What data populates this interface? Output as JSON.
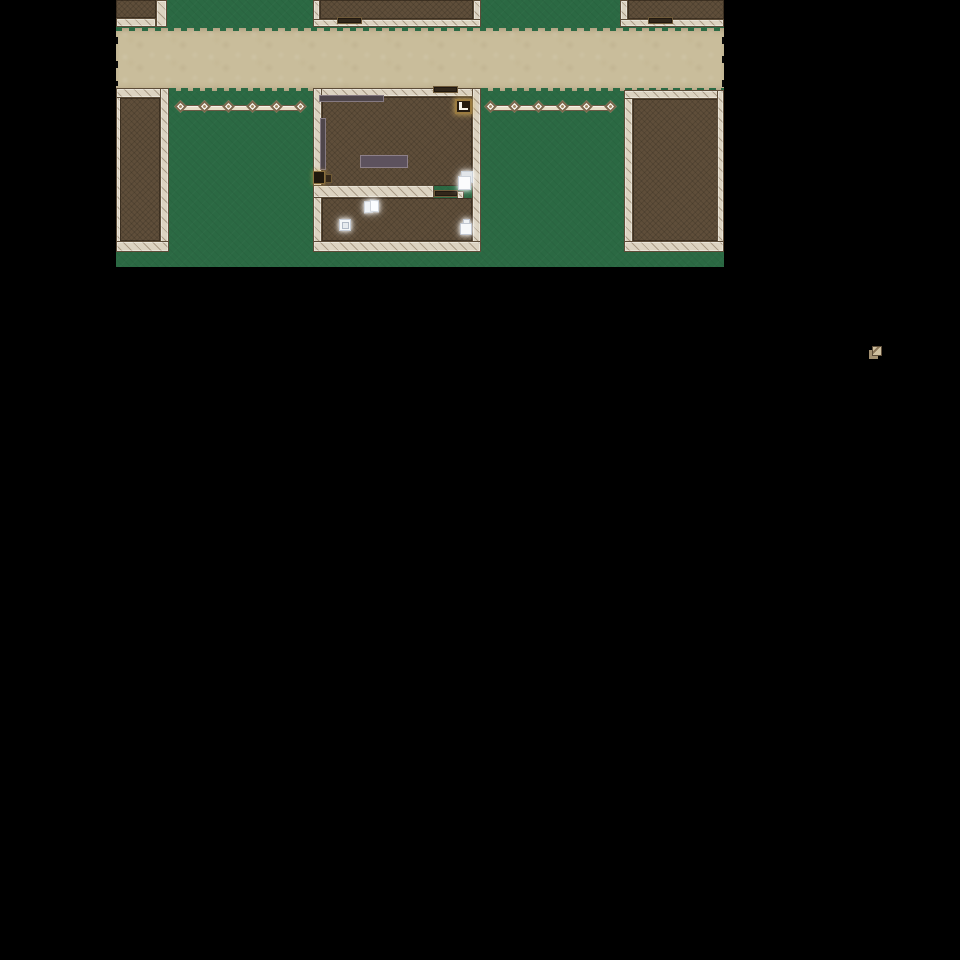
{
  "meta": {
    "app": "rpg-village-map",
    "description": "Top-down 2D RPG village scene: dirt road between buildings, fenced yards, shop interior with glowing pickup items; rest of screen is black.",
    "background": "#000000"
  },
  "palette": {
    "grass": "#2b6943",
    "path": "#c9bd9b",
    "wall_fill": "#dcd3c1",
    "wall_hatch": "#7a6650",
    "wall_edge": "#5c4c38",
    "floor": "#5f4e3a",
    "door": "#32271a",
    "fence_light": "#f2ebdb",
    "fence_dark": "#6b5944",
    "furniture_mauve": "#4f464b",
    "furniture_mauve_light": "#8d8089",
    "item_white": "#f6f8fa",
    "ledger_gold": "#9a7b40",
    "glow_warm": "#e0ba62",
    "sprite_tan": "#cfc0a0"
  },
  "map": {
    "x": 116,
    "y": 0,
    "width": 608,
    "height": 267,
    "elements": [
      {
        "name": "dirt-road",
        "type": "path",
        "x": 0,
        "y": 28,
        "w": 608,
        "h": 63,
        "interactable": false
      },
      {
        "name": "dirt-road-edge-top",
        "type": "path-edge-top",
        "x": 0,
        "y": 28,
        "w": 608,
        "h": 3,
        "interactable": false
      },
      {
        "name": "dirt-road-edge-bottom",
        "type": "path-edge-bottom",
        "x": 0,
        "y": 88,
        "w": 608,
        "h": 3,
        "interactable": false
      },
      {
        "name": "map-edge-tick-w1",
        "type": "edge-tick",
        "x": 0,
        "y": 37,
        "w": 2,
        "h": 7,
        "interactable": false
      },
      {
        "name": "map-edge-tick-w2",
        "type": "edge-tick",
        "x": 0,
        "y": 61,
        "w": 2,
        "h": 7,
        "interactable": false
      },
      {
        "name": "map-edge-tick-w3",
        "type": "edge-tick",
        "x": 0,
        "y": 81,
        "w": 2,
        "h": 5,
        "interactable": false
      },
      {
        "name": "map-edge-tick-e1",
        "type": "edge-tick",
        "x": 606,
        "y": 37,
        "w": 2,
        "h": 7,
        "interactable": false
      },
      {
        "name": "map-edge-tick-e2",
        "type": "edge-tick",
        "x": 606,
        "y": 56,
        "w": 2,
        "h": 7,
        "interactable": false
      },
      {
        "name": "map-edge-tick-e3",
        "type": "edge-tick",
        "x": 606,
        "y": 80,
        "w": 2,
        "h": 7,
        "interactable": false
      },
      {
        "name": "map-edge-tick-e4",
        "type": "edge-tick",
        "x": 606,
        "y": 97,
        "w": 2,
        "h": 6,
        "interactable": false
      },
      {
        "name": "building-nw-floor",
        "type": "floor",
        "x": 0,
        "y": 0,
        "w": 40,
        "h": 18,
        "interactable": false
      },
      {
        "name": "building-nw-wall-right",
        "type": "wall-v",
        "x": 40,
        "y": 0,
        "w": 11,
        "h": 27,
        "interactable": false
      },
      {
        "name": "building-nw-wall-bottom",
        "type": "wall-h",
        "x": 0,
        "y": 18,
        "w": 40,
        "h": 9,
        "interactable": false
      },
      {
        "name": "building-n-wall-left",
        "type": "wall-v",
        "x": 197,
        "y": 0,
        "w": 7,
        "h": 27,
        "interactable": false
      },
      {
        "name": "building-n-floor",
        "type": "floor",
        "x": 204,
        "y": 0,
        "w": 153,
        "h": 19,
        "interactable": false
      },
      {
        "name": "building-n-wall-right",
        "type": "wall-v",
        "x": 357,
        "y": 0,
        "w": 8,
        "h": 27,
        "interactable": false
      },
      {
        "name": "building-n-wall-bottom",
        "type": "wall-h",
        "x": 197,
        "y": 19,
        "w": 168,
        "h": 8,
        "interactable": false
      },
      {
        "name": "building-n-door",
        "type": "door-lintel",
        "x": 221,
        "y": 17,
        "w": 25,
        "h": 7,
        "interactable": true
      },
      {
        "name": "building-ne-wall-left",
        "type": "wall-v",
        "x": 504,
        "y": 0,
        "w": 8,
        "h": 27,
        "interactable": false
      },
      {
        "name": "building-ne-floor",
        "type": "floor",
        "x": 512,
        "y": 0,
        "w": 96,
        "h": 19,
        "interactable": false
      },
      {
        "name": "building-ne-wall-bottom",
        "type": "wall-h",
        "x": 504,
        "y": 19,
        "w": 104,
        "h": 8,
        "interactable": false
      },
      {
        "name": "building-ne-door",
        "type": "door-lintel",
        "x": 532,
        "y": 17,
        "w": 25,
        "h": 7,
        "interactable": true
      },
      {
        "name": "fence-west-rail",
        "type": "fence-rail",
        "x": 64,
        "y": 105,
        "w": 122,
        "h": 6,
        "interactable": false
      },
      {
        "name": "fence-west-post-1",
        "type": "fence-post",
        "x": 60,
        "y": 102,
        "w": 9,
        "h": 9,
        "interactable": false
      },
      {
        "name": "fence-west-post-2",
        "type": "fence-post",
        "x": 84,
        "y": 102,
        "w": 9,
        "h": 9,
        "interactable": false
      },
      {
        "name": "fence-west-post-3",
        "type": "fence-post",
        "x": 108,
        "y": 102,
        "w": 9,
        "h": 9,
        "interactable": false
      },
      {
        "name": "fence-west-post-4",
        "type": "fence-post",
        "x": 132,
        "y": 102,
        "w": 9,
        "h": 9,
        "interactable": false
      },
      {
        "name": "fence-west-post-5",
        "type": "fence-post",
        "x": 156,
        "y": 102,
        "w": 9,
        "h": 9,
        "interactable": false
      },
      {
        "name": "fence-west-post-6",
        "type": "fence-post",
        "x": 180,
        "y": 102,
        "w": 9,
        "h": 9,
        "interactable": false
      },
      {
        "name": "fence-east-rail",
        "type": "fence-rail",
        "x": 375,
        "y": 105,
        "w": 122,
        "h": 6,
        "interactable": false
      },
      {
        "name": "fence-east-post-1",
        "type": "fence-post",
        "x": 370,
        "y": 102,
        "w": 9,
        "h": 9,
        "interactable": false
      },
      {
        "name": "fence-east-post-2",
        "type": "fence-post",
        "x": 394,
        "y": 102,
        "w": 9,
        "h": 9,
        "interactable": false
      },
      {
        "name": "fence-east-post-3",
        "type": "fence-post",
        "x": 418,
        "y": 102,
        "w": 9,
        "h": 9,
        "interactable": false
      },
      {
        "name": "fence-east-post-4",
        "type": "fence-post",
        "x": 442,
        "y": 102,
        "w": 9,
        "h": 9,
        "interactable": false
      },
      {
        "name": "fence-east-post-5",
        "type": "fence-post",
        "x": 466,
        "y": 102,
        "w": 9,
        "h": 9,
        "interactable": false
      },
      {
        "name": "fence-east-post-6",
        "type": "fence-post",
        "x": 490,
        "y": 102,
        "w": 9,
        "h": 9,
        "interactable": false
      },
      {
        "name": "building-sw-wall-left",
        "type": "wall-v",
        "x": 0,
        "y": 88,
        "w": 5,
        "h": 164,
        "interactable": false
      },
      {
        "name": "building-sw-wall-top",
        "type": "wall-h",
        "x": 0,
        "y": 88,
        "w": 53,
        "h": 10,
        "interactable": false
      },
      {
        "name": "building-sw-floor",
        "type": "floor",
        "x": 4,
        "y": 98,
        "w": 40,
        "h": 143,
        "interactable": false
      },
      {
        "name": "building-sw-wall-right",
        "type": "wall-v",
        "x": 44,
        "y": 88,
        "w": 9,
        "h": 164,
        "interactable": false
      },
      {
        "name": "building-sw-wall-bottom",
        "type": "wall-h",
        "x": 0,
        "y": 241,
        "w": 53,
        "h": 11,
        "interactable": false
      },
      {
        "name": "building-se-wall-left",
        "type": "wall-v",
        "x": 508,
        "y": 90,
        "w": 9,
        "h": 162,
        "interactable": false
      },
      {
        "name": "building-se-wall-top",
        "type": "wall-h",
        "x": 508,
        "y": 90,
        "w": 100,
        "h": 9,
        "interactable": false
      },
      {
        "name": "building-se-floor",
        "type": "floor",
        "x": 517,
        "y": 99,
        "w": 85,
        "h": 142,
        "interactable": false
      },
      {
        "name": "building-se-wall-right",
        "type": "wall-v",
        "x": 601,
        "y": 90,
        "w": 7,
        "h": 162,
        "interactable": false
      },
      {
        "name": "building-se-wall-bottom",
        "type": "wall-h",
        "x": 508,
        "y": 241,
        "w": 100,
        "h": 11,
        "interactable": false
      },
      {
        "name": "shop-wall-top",
        "type": "wall-h",
        "x": 197,
        "y": 88,
        "w": 168,
        "h": 9,
        "interactable": false
      },
      {
        "name": "shop-wall-left",
        "type": "wall-v",
        "x": 197,
        "y": 88,
        "w": 9,
        "h": 164,
        "interactable": false
      },
      {
        "name": "shop-wall-right",
        "type": "wall-v",
        "x": 356,
        "y": 88,
        "w": 9,
        "h": 164,
        "interactable": false
      },
      {
        "name": "shop-floor-main",
        "type": "floor",
        "x": 206,
        "y": 97,
        "w": 150,
        "h": 89,
        "interactable": false
      },
      {
        "name": "shop-door-top",
        "type": "door-lintel",
        "x": 317,
        "y": 86,
        "w": 25,
        "h": 7,
        "interactable": true
      },
      {
        "name": "shop-divider-wall",
        "type": "wall-h",
        "x": 197,
        "y": 185,
        "w": 121,
        "h": 13,
        "interactable": false
      },
      {
        "name": "shop-divider-step",
        "type": "wall-h",
        "x": 341,
        "y": 191,
        "w": 7,
        "h": 8,
        "interactable": false
      },
      {
        "name": "shop-door-inner",
        "type": "door-lintel",
        "x": 318,
        "y": 190,
        "w": 24,
        "h": 7,
        "interactable": true
      },
      {
        "name": "shop-floor-back",
        "type": "floor",
        "x": 206,
        "y": 198,
        "w": 150,
        "h": 43,
        "interactable": false
      },
      {
        "name": "shop-wall-bottom",
        "type": "wall-h",
        "x": 197,
        "y": 241,
        "w": 168,
        "h": 11,
        "interactable": false
      },
      {
        "name": "shop-counter-shelf",
        "type": "shelf-h",
        "x": 203,
        "y": 95,
        "w": 65,
        "h": 7,
        "interactable": false
      },
      {
        "name": "shop-side-shelf",
        "type": "shelf-v",
        "x": 204,
        "y": 118,
        "w": 6,
        "h": 52,
        "interactable": false
      },
      {
        "name": "shop-table",
        "type": "table",
        "x": 244,
        "y": 155,
        "w": 48,
        "h": 13,
        "interactable": false
      },
      {
        "name": "open-ledger-item",
        "type": "ledger",
        "x": 339,
        "y": 99,
        "w": 17,
        "h": 15,
        "interactable": true
      },
      {
        "name": "stove-item",
        "type": "stove",
        "x": 197,
        "y": 171,
        "w": 12,
        "h": 13,
        "interactable": true
      },
      {
        "name": "stove-side-box",
        "type": "stove-side",
        "x": 209,
        "y": 174,
        "w": 7,
        "h": 9,
        "interactable": false
      },
      {
        "name": "paper-note-item",
        "type": "paper-note glow",
        "x": 342,
        "y": 171,
        "w": 15,
        "h": 18,
        "interactable": true
      },
      {
        "name": "open-book-item",
        "type": "book-open glow",
        "x": 248,
        "y": 200,
        "w": 15,
        "h": 11,
        "interactable": true
      },
      {
        "name": "parcel-box-item",
        "type": "parcel-box glow",
        "x": 223,
        "y": 219,
        "w": 12,
        "h": 12,
        "interactable": true
      },
      {
        "name": "jar-pot-item",
        "type": "jar-pot glow",
        "x": 344,
        "y": 219,
        "w": 12,
        "h": 16,
        "interactable": true
      }
    ]
  },
  "overlay_sprite": {
    "name": "scroll-item-icon",
    "x": 869,
    "y": 346,
    "width": 13,
    "height": 13
  }
}
